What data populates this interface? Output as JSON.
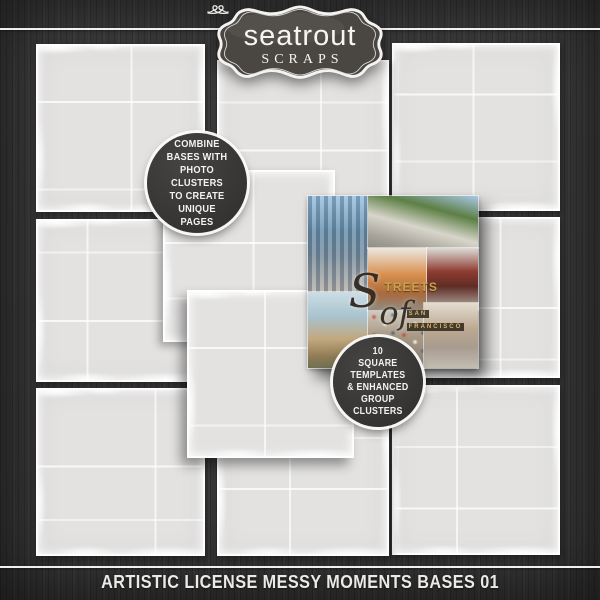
{
  "brand": {
    "line1": "seatrout",
    "line2": "SCRAPS"
  },
  "badges": {
    "left": {
      "lines": [
        "COMBINE",
        "BASES WITH",
        "PHOTO CLUSTERS",
        "TO CREATE",
        "UNIQUE",
        "PAGES"
      ]
    },
    "right": {
      "lines": [
        "10",
        "SQUARE",
        "TEMPLATES",
        "& ENHANCED",
        "GROUP",
        "CLUSTERS"
      ]
    }
  },
  "collage": {
    "title": {
      "script_initial": "S",
      "caps": "TREETS",
      "script_word": "of",
      "sub1": "SAN",
      "sub2": "FRANCISCO"
    }
  },
  "footer": {
    "title": "ARTISTIC LICENSE MESSY MOMENTS BASES 01"
  },
  "colors": {
    "background": "#3d3c3c",
    "square_fill": "#e3e2e1",
    "badge_background": "#3a3938",
    "accent_gold": "#c9a04e",
    "text_light": "#f2f2f2"
  }
}
